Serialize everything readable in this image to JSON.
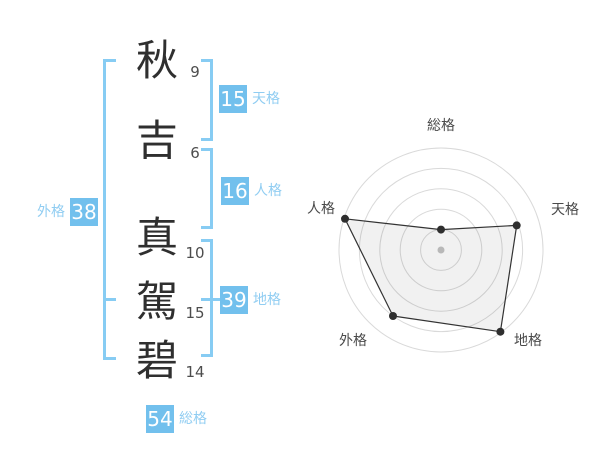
{
  "name": {
    "chars": [
      {
        "char": "秋",
        "strokes": 9
      },
      {
        "char": "吉",
        "strokes": 6
      },
      {
        "char": "真",
        "strokes": 10
      },
      {
        "char": "駕",
        "strokes": 15
      },
      {
        "char": "碧",
        "strokes": 14
      }
    ]
  },
  "kaku": {
    "tenkaku": {
      "label": "天格",
      "value": 15
    },
    "jinkaku": {
      "label": "人格",
      "value": 16
    },
    "chikaku": {
      "label": "地格",
      "value": 39
    },
    "gaikaku": {
      "label": "外格",
      "value": 38
    },
    "soukaku": {
      "label": "総格",
      "value": 54
    }
  },
  "colors": {
    "badge_bg": "#72c0ed",
    "badge_text": "#ffffff",
    "bracket": "#87ccf3",
    "kaku_label": "#90cdf2",
    "kanji": "#2f2f2f",
    "stroke_count": "#4d4d4d",
    "background": "#ffffff"
  },
  "chart_data": {
    "type": "radar",
    "title": "",
    "axes": [
      "総格",
      "天格",
      "地格",
      "外格",
      "人格"
    ],
    "values": [
      20,
      78,
      99,
      80,
      99
    ],
    "scale_max": 100,
    "rings": 5,
    "start_angle_deg": -90,
    "direction": "clockwise",
    "legend": "none",
    "colors": {
      "ring": "#d9d9d9",
      "polygon_stroke": "#333333",
      "polygon_fill": "#000000",
      "polygon_fill_opacity": 0.055,
      "point": "#2e2e2e",
      "center_dot": "#b8b8b8",
      "axis_label": "#4a4a4a"
    }
  }
}
